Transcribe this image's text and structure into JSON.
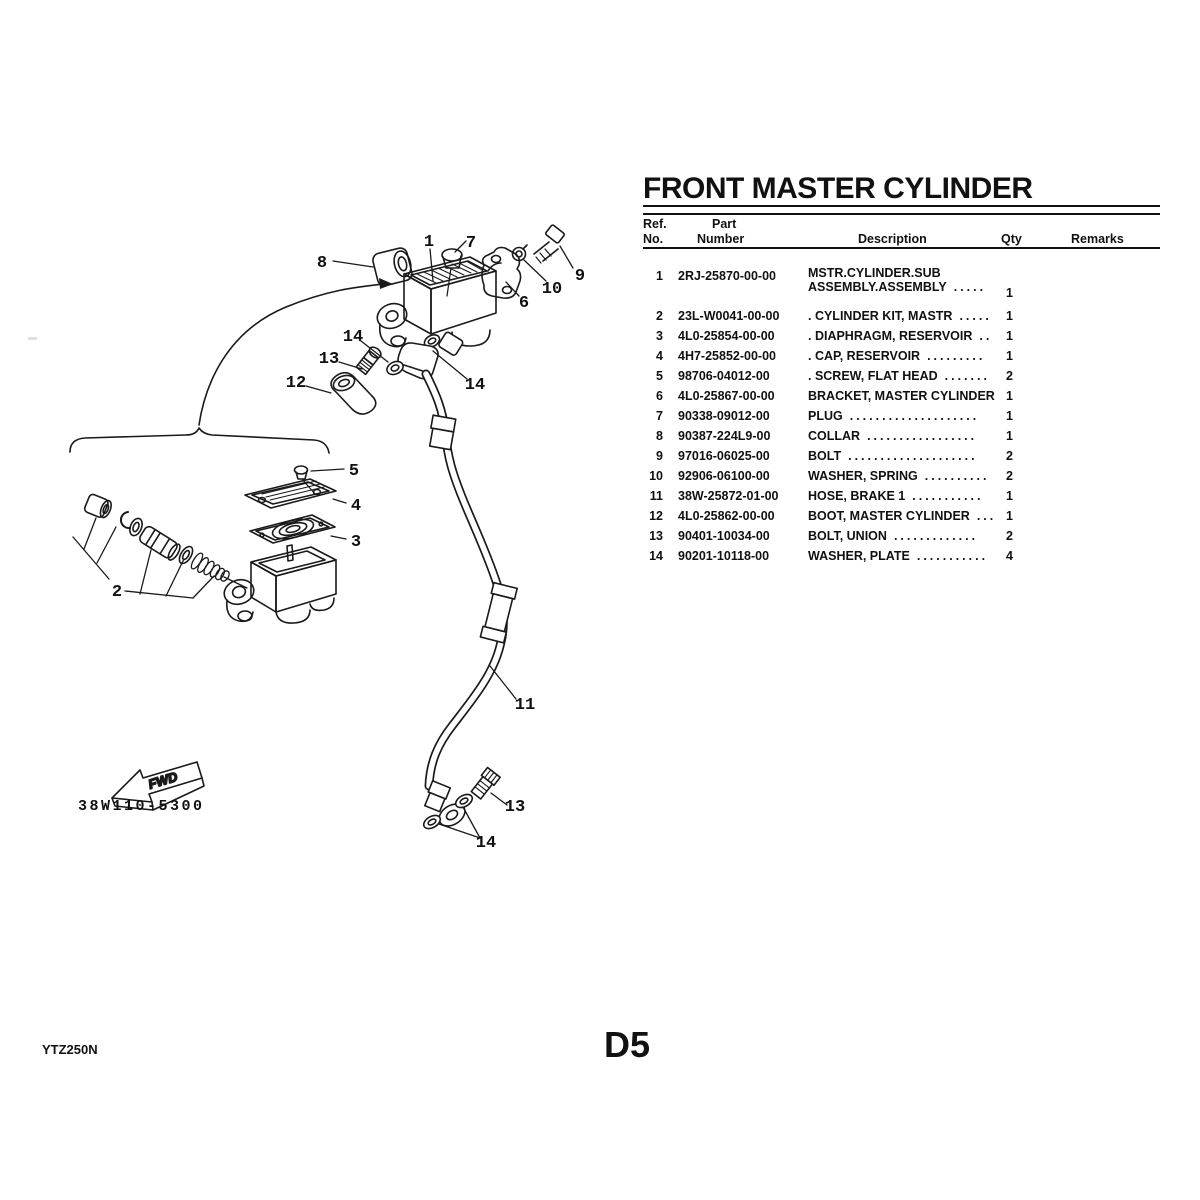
{
  "title": "FRONT MASTER CYLINDER",
  "page": {
    "model_code": "YTZ250N",
    "page_number": "D5"
  },
  "table": {
    "headers": {
      "ref_line1": "Ref.",
      "ref_line2": "No.",
      "part_line1": "Part",
      "part_line2": "Number",
      "description": "Description",
      "qty": "Qty",
      "remarks": "Remarks"
    },
    "rows": [
      {
        "ref": "1",
        "part": "2RJ-25870-00-00",
        "desc_line1": "MSTR.CYLINDER.SUB",
        "desc_line2": "ASSEMBLY.ASSEMBLY",
        "dots": ".....",
        "qty": "1"
      },
      {
        "ref": "2",
        "part": "23L-W0041-00-00",
        "desc": ". CYLINDER KIT, MASTR",
        "dots": ".....",
        "qty": "1"
      },
      {
        "ref": "3",
        "part": "4L0-25854-00-00",
        "desc": ". DIAPHRAGM, RESERVOIR",
        "dots": "..",
        "qty": "1"
      },
      {
        "ref": "4",
        "part": "4H7-25852-00-00",
        "desc": ". CAP, RESERVOIR",
        "dots": ".........",
        "qty": "1"
      },
      {
        "ref": "5",
        "part": "98706-04012-00",
        "desc": ". SCREW, FLAT HEAD",
        "dots": ".......",
        "qty": "2"
      },
      {
        "ref": "6",
        "part": "4L0-25867-00-00",
        "desc": "BRACKET, MASTER CYLINDER",
        "dots": "",
        "qty": "1"
      },
      {
        "ref": "7",
        "part": "90338-09012-00",
        "desc": "PLUG",
        "dots": "....................",
        "qty": "1"
      },
      {
        "ref": "8",
        "part": "90387-224L9-00",
        "desc": "COLLAR",
        "dots": ".................",
        "qty": "1"
      },
      {
        "ref": "9",
        "part": "97016-06025-00",
        "desc": "BOLT",
        "dots": "....................",
        "qty": "2"
      },
      {
        "ref": "10",
        "part": "92906-06100-00",
        "desc": "WASHER, SPRING",
        "dots": "..........",
        "qty": "2"
      },
      {
        "ref": "11",
        "part": "38W-25872-01-00",
        "desc": "HOSE, BRAKE 1",
        "dots": "...........",
        "qty": "1"
      },
      {
        "ref": "12",
        "part": "4L0-25862-00-00",
        "desc": "BOOT, MASTER CYLINDER",
        "dots": "...",
        "qty": "1"
      },
      {
        "ref": "13",
        "part": "90401-10034-00",
        "desc": "BOLT, UNION",
        "dots": ".............",
        "qty": "2"
      },
      {
        "ref": "14",
        "part": "90201-10118-00",
        "desc": "WASHER, PLATE",
        "dots": "...........",
        "qty": "4"
      }
    ]
  },
  "diagram": {
    "drawing_number": "38W110-5300",
    "fwd_label": "FWD",
    "callouts": {
      "n1": "1",
      "n7": "7",
      "n8": "8",
      "n9": "9",
      "n10": "10",
      "n6": "6",
      "n14a": "14",
      "n13a": "13",
      "n12": "12",
      "n14b": "14",
      "n2": "2",
      "n5": "5",
      "n4": "4",
      "n3": "3",
      "n11": "11",
      "n13b": "13",
      "n14c": "14"
    }
  }
}
